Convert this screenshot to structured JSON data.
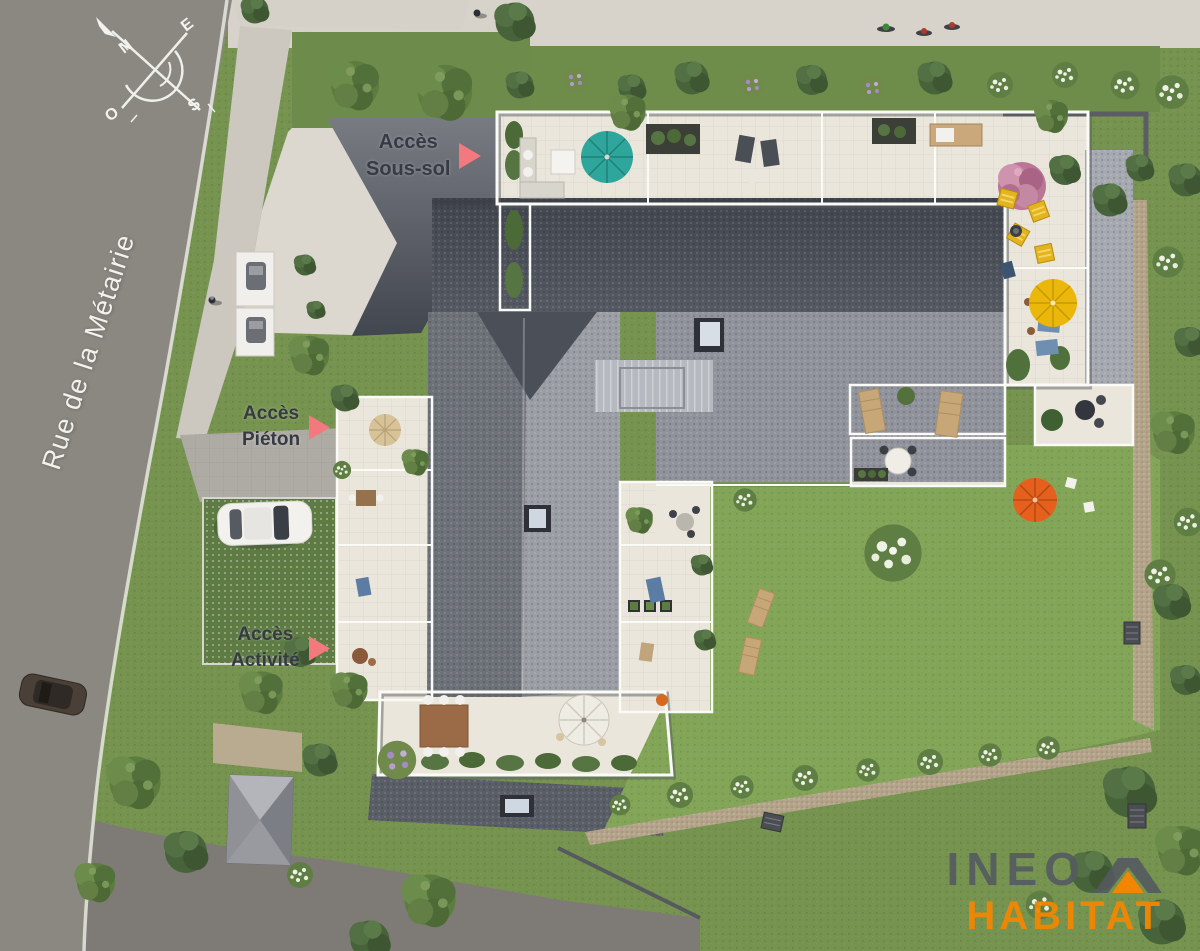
{
  "plan": {
    "street": {
      "name": "Rue de la Métairie"
    },
    "access_labels": {
      "sous_sol": {
        "line1": "Accès",
        "line2": "Sous-sol"
      },
      "pieton": {
        "line1": "Accès",
        "line2": "Piéton"
      },
      "activite": {
        "line1": "Accès",
        "line2": "Activité"
      }
    },
    "compass": {
      "north": "N",
      "east": "E",
      "south": "S",
      "west": "O"
    },
    "logo": {
      "name": "INEO",
      "division": "HABITAT"
    },
    "colors": {
      "access_arrow": "#F3797E",
      "label_text": "#363A43",
      "logo_gray": "#565C63",
      "logo_orange": "#F28602",
      "umbrella_teal": "#2EA69C",
      "umbrella_yellow": "#EBB70A",
      "umbrella_orange": "#E5601C",
      "umbrella_white": "#EFECE3",
      "umbrella_tan": "#D8C298"
    }
  }
}
